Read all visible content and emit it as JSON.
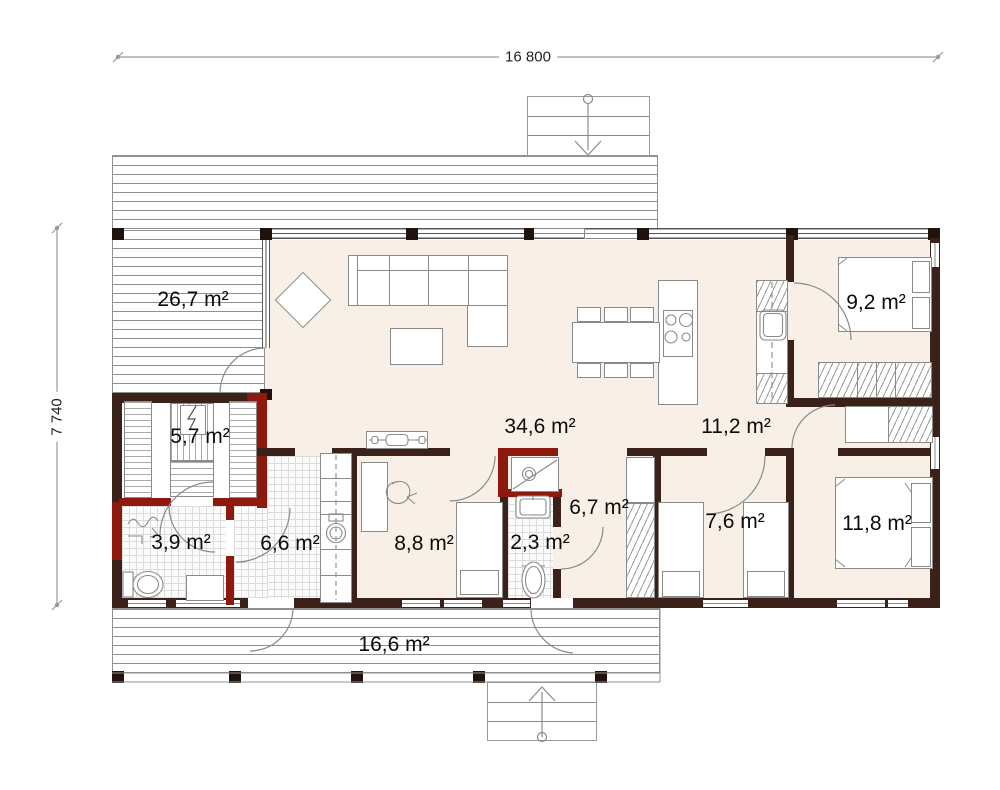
{
  "dimensions": {
    "width_label": "16 800",
    "height_label": "7 740"
  },
  "rooms": [
    {
      "id": "terrace-upper",
      "label": "26,7 m²"
    },
    {
      "id": "bedroom-small",
      "label": "9,2 m²"
    },
    {
      "id": "sauna",
      "label": "5,7 m²"
    },
    {
      "id": "living-kitchen",
      "label": "34,6 m²"
    },
    {
      "id": "hallway",
      "label": "11,2 m²"
    },
    {
      "id": "entry-hall",
      "label": "6,7 m²"
    },
    {
      "id": "bathroom",
      "label": "3,9 m²"
    },
    {
      "id": "utility-room",
      "label": "6,6 m²"
    },
    {
      "id": "office-bedroom",
      "label": "8,8 m²"
    },
    {
      "id": "wc",
      "label": "2,3 m²"
    },
    {
      "id": "kids-room",
      "label": "7,6 m²"
    },
    {
      "id": "bedroom-master",
      "label": "11,8 m²"
    },
    {
      "id": "terrace-lower",
      "label": "16,6 m²"
    }
  ],
  "colors": {
    "wall_dark": "#3a211a",
    "wall_accent_red": "#8e1a0f",
    "floor_cream": "#f8f0e7",
    "line_gray": "#8a8a8a"
  }
}
